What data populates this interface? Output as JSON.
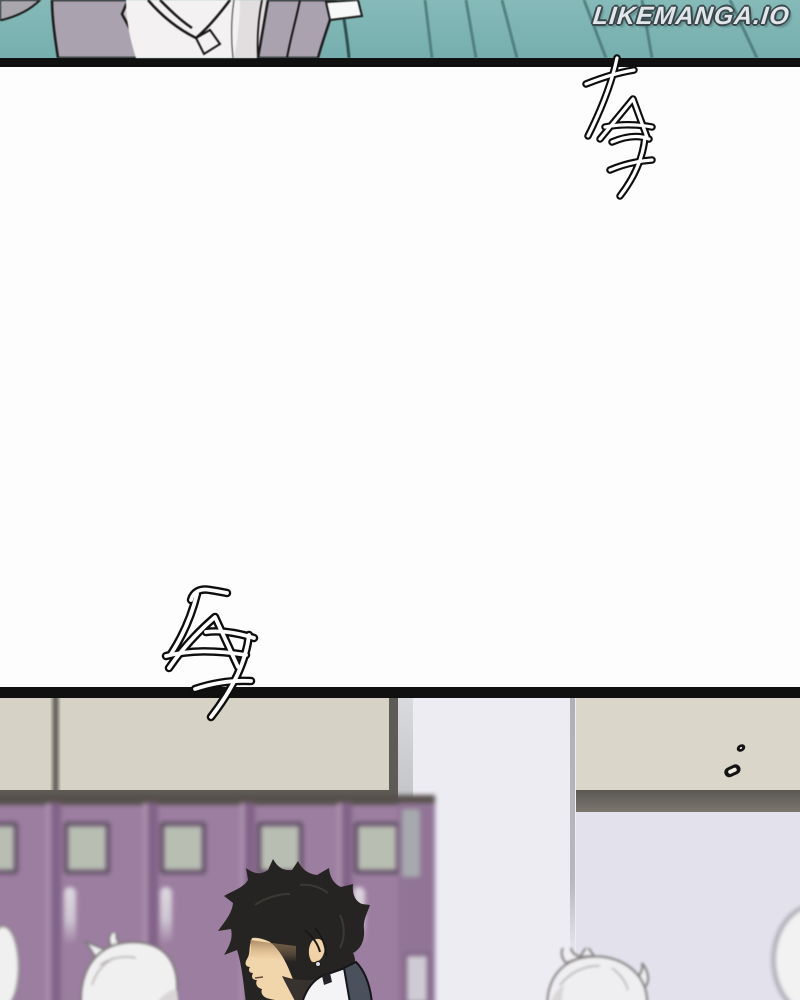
{
  "watermark": {
    "text": "LIKEMANGA.IO"
  },
  "sfx": {
    "top": {
      "text": "TA7",
      "style": "hand-drawn white sfx lettering with black outline, cascading diagonally"
    },
    "middle": {
      "text": "TA7",
      "style": "hand-drawn white sfx lettering with black outline, crossing the panel border"
    }
  },
  "scene": {
    "top_panel": "classroom scene: person in grey blazer and white shirt against a teal wall with diagonal lines and a small placard",
    "bottom_panel": "school hallway: blurred purple lockers, black-haired student in profile, blurred white-haired students, two small ink marks on the wall"
  },
  "colors": {
    "paper": "#fdfdfd",
    "panel-border": "#101010",
    "teal": "#7fb5b4",
    "teal-line": "#4a7b7a",
    "jacket": "#aba2b0",
    "shirt": "#f3f1f1",
    "beige-wall": "#d7d2c6",
    "beige-wall-right": "#dbd6ca",
    "wall-outline": "#5e5a55",
    "lavender-left": "#edecf3",
    "lavender-right": "#e3e2ec",
    "locker": "#9c7ea0",
    "locker-frame": "#826388",
    "locker-window": "#b9beb3",
    "hair": "#262422",
    "skin": "#f2d6ab",
    "blazer": "#4a505c",
    "white-hair": "#f1f0f1"
  }
}
